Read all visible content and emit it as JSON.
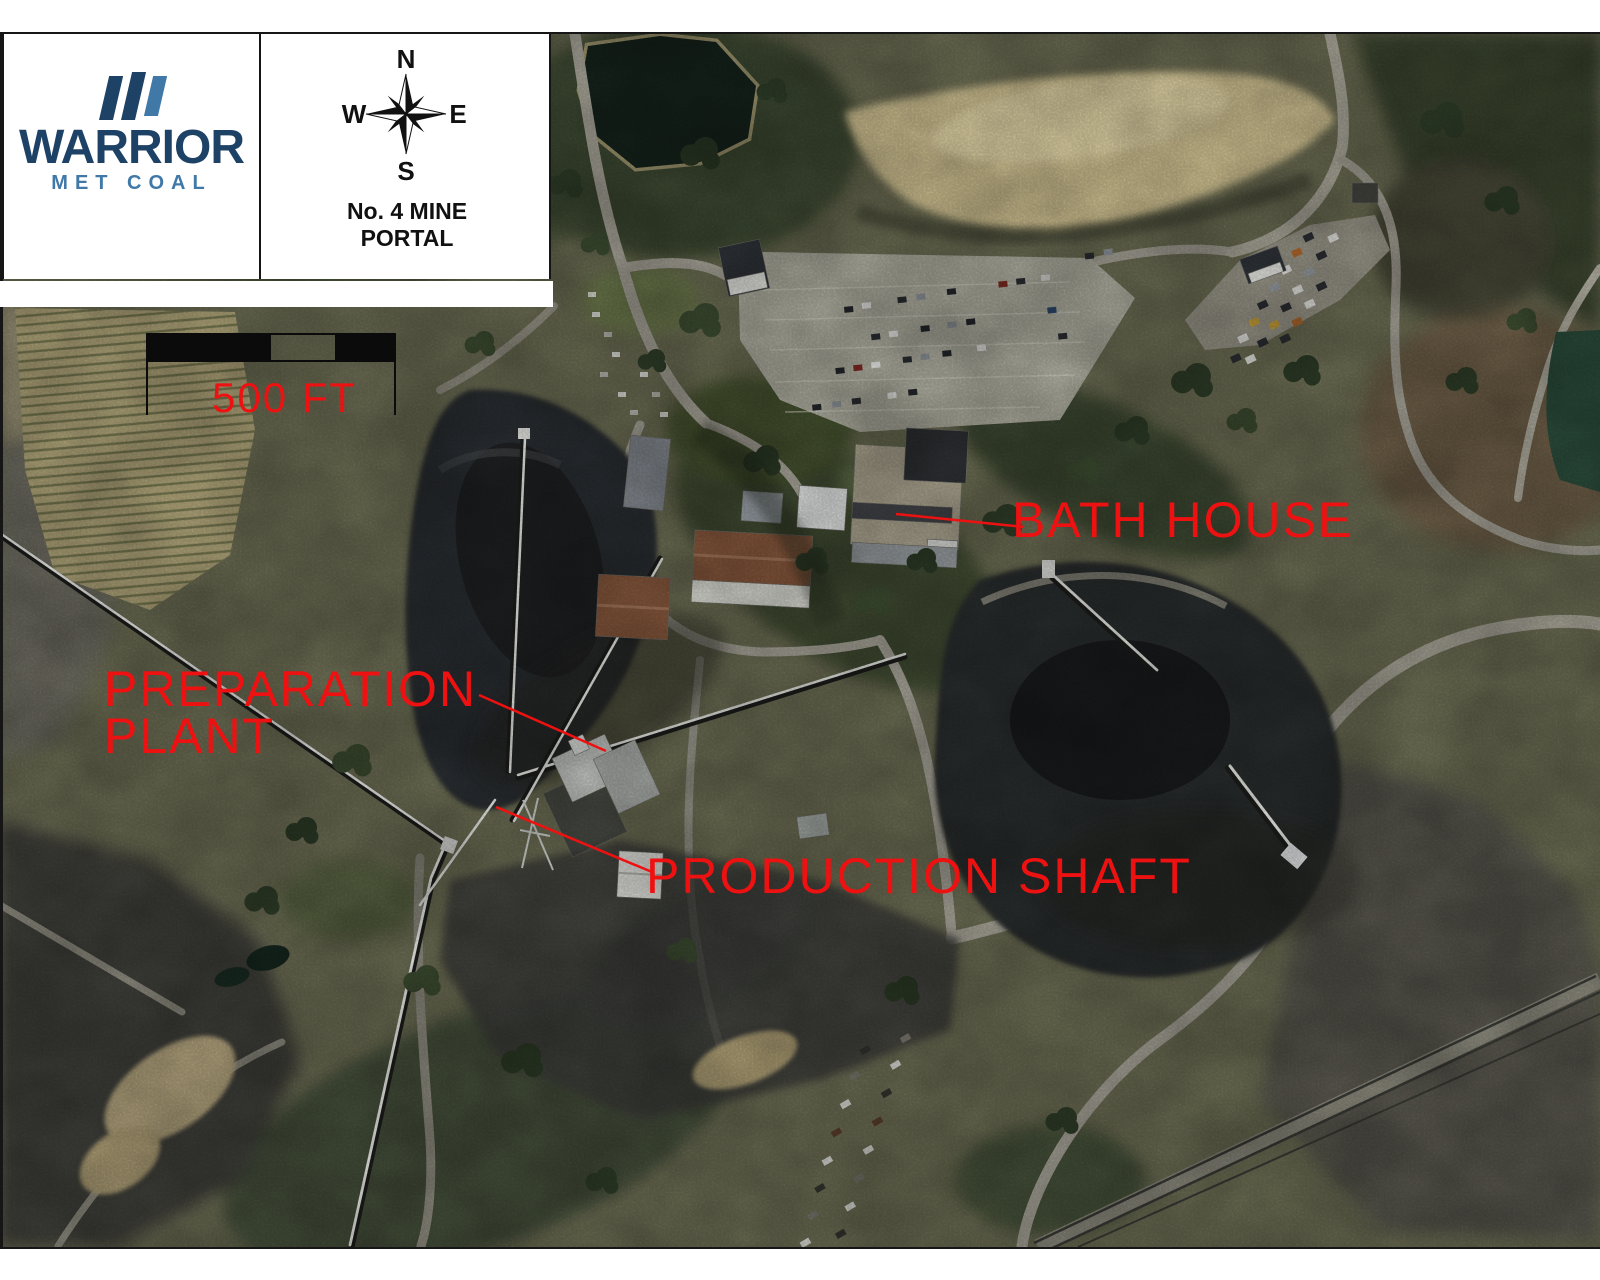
{
  "legend": {
    "brand": {
      "name": "WARRIOR",
      "tagline": "MET COAL"
    },
    "compass": {
      "north": "N",
      "east": "E",
      "south": "S",
      "west": "W"
    },
    "map_title": {
      "line1": "No. 4 MINE",
      "line2": "PORTAL"
    },
    "scale": {
      "label": "500 FT"
    }
  },
  "annotations": {
    "color": "#ee1111",
    "labels": {
      "bath_house": "BATH HOUSE",
      "preparation_plant_line1": "PREPARATION",
      "preparation_plant_line2": "PLANT",
      "production_shaft": "PRODUCTION SHAFT"
    }
  },
  "colors": {
    "logo_navy": "#1e4265",
    "logo_blue": "#4079a8",
    "annotation_red": "#ee1111"
  }
}
